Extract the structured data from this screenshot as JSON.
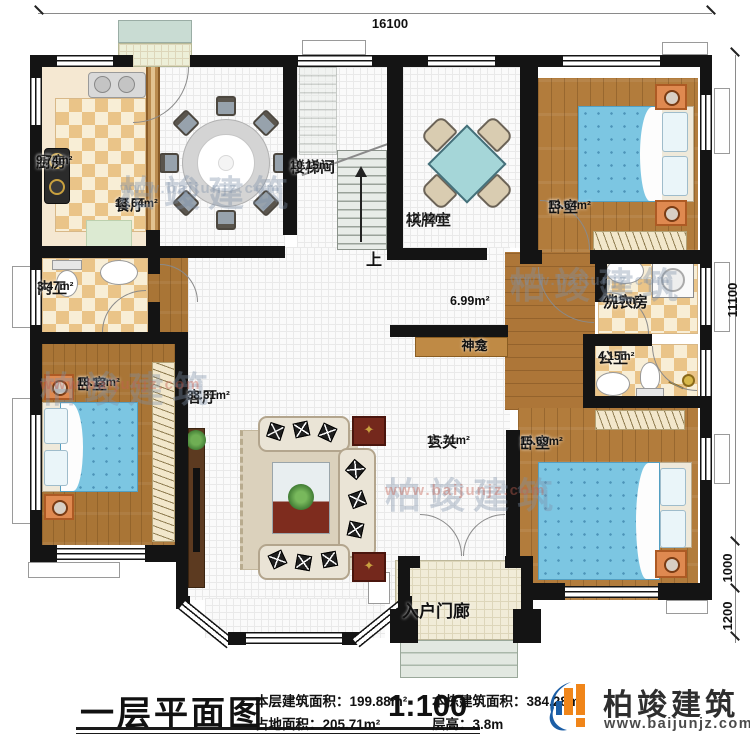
{
  "dimensions": {
    "top": "16100",
    "right_main": "11100",
    "right_upper": "1000",
    "right_lower": "1200"
  },
  "rooms": {
    "kitchen": {
      "name": "厨房",
      "area": "9.74m²"
    },
    "dining": {
      "name": "餐厅",
      "area": "13.64m²"
    },
    "stairwell": {
      "name": "楼梯间",
      "area": "10.15m²"
    },
    "mahjong": {
      "name": "棋牌室",
      "area": "12.42m²"
    },
    "bedroom_ne": {
      "name": "卧室",
      "area": "13.64m²"
    },
    "inner_bath": {
      "name": "内卫",
      "area": "3.47m²"
    },
    "bedroom_w": {
      "name": "卧室",
      "area": "18.13m²"
    },
    "living": {
      "name": "客厅",
      "area": "38.31m²"
    },
    "corridor": {
      "area": "6.99m²"
    },
    "shrine": {
      "name": "神龛"
    },
    "foyer": {
      "name": "玄关",
      "area": "15.71m²"
    },
    "laundry": {
      "name": "洗衣房",
      "area": "4.15m²"
    },
    "public_bath": {
      "name": "公卫",
      "area": "4.15m²"
    },
    "bedroom_se": {
      "name": "卧室",
      "area": "15.69m²"
    },
    "porch": {
      "name": "入户门廊"
    }
  },
  "stairs": {
    "up_label": "上"
  },
  "title_block": {
    "title": "一层平面图",
    "scale": "1:100",
    "stats": [
      {
        "label": "本层建筑面积：",
        "value": "199.88m²"
      },
      {
        "label": "占地面积：",
        "value": "205.71m²"
      },
      {
        "label": "本栋建筑面积：",
        "value": "384.28m²"
      },
      {
        "label": "层高：",
        "value": "3.8m"
      }
    ]
  },
  "logo": {
    "name": "柏竣建筑",
    "url": "www.baijunjz.com"
  },
  "watermark": {
    "text": "柏竣建筑",
    "url": "www.baijunjz.com"
  },
  "colors": {
    "wall": "#141414",
    "wood": "#b27c3c",
    "tile": "#fafafa",
    "checker_tan": "#eac488",
    "bed_blue": "#7cc6e2",
    "nightstand_orange": "#df8950",
    "table_cyan": "#a5d6d8",
    "shrine_brown": "#bf8a45",
    "logo_blue": "#1b5ea6",
    "logo_orange": "#f08519"
  }
}
